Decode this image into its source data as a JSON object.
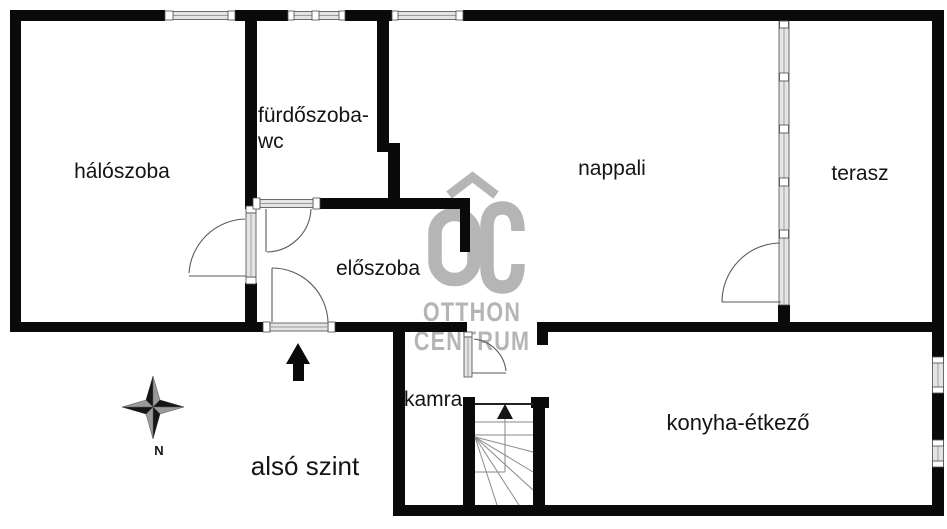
{
  "rooms": {
    "bedroom": "hálószoba",
    "bathroom_line1": "fürdőszoba-",
    "bathroom_line2": "wc",
    "living_room": "nappali",
    "terrace": "terasz",
    "hallway": "előszoba",
    "pantry": "kamra",
    "kitchen_dining": "konyha-étkező"
  },
  "floor_label": "alsó szint",
  "compass": {
    "north": "N"
  },
  "watermark": {
    "monogram": "OC",
    "line1": "OTTHON",
    "line2": "CENTRUM"
  },
  "colors": {
    "wall": "#0a0a0a",
    "window_fill": "#e4e4e4",
    "watermark_gray": "#b5b5b5"
  }
}
